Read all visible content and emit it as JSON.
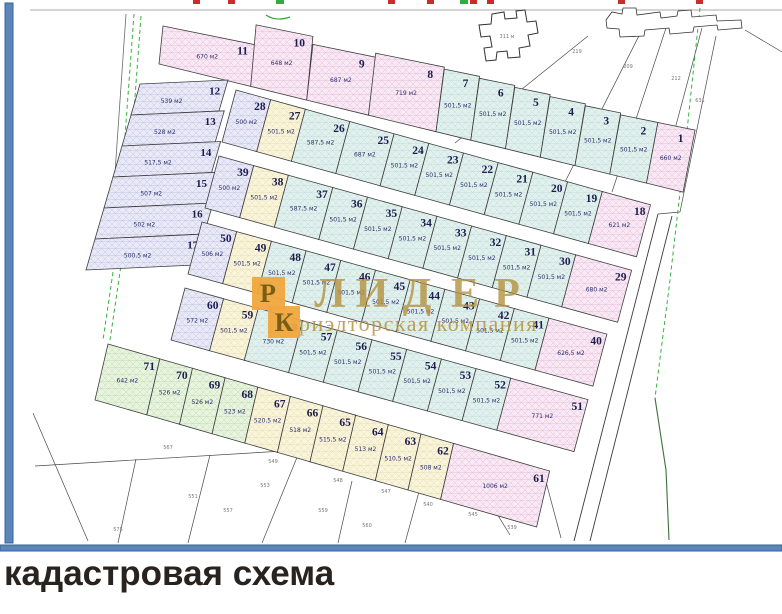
{
  "frame": {
    "caption": "кадастровая схема"
  },
  "watermark": {
    "letters": [
      "Л",
      "И",
      "Д",
      "Е",
      "Р"
    ],
    "subtitle": "риэлторская компания",
    "square1": "Р",
    "square2": "К"
  },
  "palette": {
    "pink": {
      "fill": "#f8e9f4",
      "hatch": "#e5bcdb"
    },
    "cyan": {
      "fill": "#e3f1ee",
      "hatch": "#bedcd6"
    },
    "lavender": {
      "fill": "#e9e9f7",
      "hatch": "#c0c3e3"
    },
    "cream": {
      "fill": "#f9f4da",
      "hatch": "#e7ddb4"
    },
    "green": {
      "fill": "#e8f4e0",
      "hatch": "#bedcae"
    }
  },
  "accents": {
    "frame_blue": "#5b86b7",
    "frame_blue_dark": "#35629c",
    "gold": "#b5923f",
    "orange": "#f0a63d",
    "red_mark": "#cc2b2b",
    "green_mark": "#2fae3f",
    "boundary_green": "#35b33f",
    "boundary_green_dark": "#3f6f3a"
  },
  "map": {
    "building_label": "311 м",
    "rows": [
      {
        "id": "strip-top",
        "plots": [
          {
            "n": "11",
            "a": "670 м2",
            "c": "pink"
          },
          {
            "n": "10",
            "a": "648 м2",
            "c": "pink"
          },
          {
            "n": "9",
            "a": "687 м2",
            "c": "pink"
          },
          {
            "n": "8",
            "a": "719 м2",
            "c": "pink"
          },
          {
            "n": "7",
            "a": "501,5 м2",
            "c": "cyan"
          },
          {
            "n": "6",
            "a": "501,5 м2",
            "c": "cyan"
          },
          {
            "n": "5",
            "a": "501,5 м2",
            "c": "cyan"
          },
          {
            "n": "4",
            "a": "501,5 м2",
            "c": "cyan"
          },
          {
            "n": "3",
            "a": "501,5 м2",
            "c": "cyan"
          },
          {
            "n": "2",
            "a": "501,5 м2",
            "c": "cyan"
          },
          {
            "n": "1",
            "a": "660 м2",
            "c": "pink"
          }
        ]
      },
      {
        "id": "left-col",
        "plots": [
          {
            "n": "12",
            "a": "539 м2",
            "c": "lavender"
          },
          {
            "n": "13",
            "a": "528 м2",
            "c": "lavender"
          },
          {
            "n": "14",
            "a": "517,5 м2",
            "c": "lavender"
          },
          {
            "n": "15",
            "a": "507 м2",
            "c": "lavender"
          },
          {
            "n": "16",
            "a": "502 м2",
            "c": "lavender"
          },
          {
            "n": "17",
            "a": "500,5 м2",
            "c": "lavender"
          }
        ]
      },
      {
        "id": "row-2",
        "plots": [
          {
            "n": "28",
            "a": "500 м2",
            "c": "lavender"
          },
          {
            "n": "27",
            "a": "501,5 м2",
            "c": "cream"
          },
          {
            "n": "26",
            "a": "587,5 м2",
            "c": "cyan"
          },
          {
            "n": "25",
            "a": "687 м2",
            "c": "cyan"
          },
          {
            "n": "24",
            "a": "501,5 м2",
            "c": "cyan"
          },
          {
            "n": "23",
            "a": "501,5 м2",
            "c": "cyan"
          },
          {
            "n": "22",
            "a": "501,5 м2",
            "c": "cyan"
          },
          {
            "n": "21",
            "a": "501,5 м2",
            "c": "cyan"
          },
          {
            "n": "20",
            "a": "501,5 м2",
            "c": "cyan"
          },
          {
            "n": "19",
            "a": "501,5 м2",
            "c": "cyan"
          },
          {
            "n": "18",
            "a": "621 м2",
            "c": "pink"
          }
        ]
      },
      {
        "id": "row-3",
        "plots": [
          {
            "n": "39",
            "a": "500 м2",
            "c": "lavender"
          },
          {
            "n": "38",
            "a": "501,5 м2",
            "c": "cream"
          },
          {
            "n": "37",
            "a": "587,5 м2",
            "c": "cyan"
          },
          {
            "n": "36",
            "a": "501,5 м2",
            "c": "cyan"
          },
          {
            "n": "35",
            "a": "501,5 м2",
            "c": "cyan"
          },
          {
            "n": "34",
            "a": "501,5 м2",
            "c": "cyan"
          },
          {
            "n": "33",
            "a": "501,5 м2",
            "c": "cyan"
          },
          {
            "n": "32",
            "a": "501,5 м2",
            "c": "cyan"
          },
          {
            "n": "31",
            "a": "501,5 м2",
            "c": "cyan"
          },
          {
            "n": "30",
            "a": "501,5 м2",
            "c": "cyan"
          },
          {
            "n": "29",
            "a": "680 м2",
            "c": "pink"
          }
        ]
      },
      {
        "id": "row-4",
        "plots": [
          {
            "n": "50",
            "a": "506 м2",
            "c": "lavender"
          },
          {
            "n": "49",
            "a": "501,5 м2",
            "c": "cream"
          },
          {
            "n": "48",
            "a": "501,5 м2",
            "c": "cyan"
          },
          {
            "n": "47",
            "a": "501,5 м2",
            "c": "cyan"
          },
          {
            "n": "46",
            "a": "501,5 м2",
            "c": "cyan"
          },
          {
            "n": "45",
            "a": "501,5 м2",
            "c": "cyan"
          },
          {
            "n": "44",
            "a": "501,5 м2",
            "c": "cyan"
          },
          {
            "n": "43",
            "a": "501,5 м2",
            "c": "cyan"
          },
          {
            "n": "42",
            "a": "501,5 м2",
            "c": "cyan"
          },
          {
            "n": "41",
            "a": "501,5 м2",
            "c": "cyan"
          },
          {
            "n": "40",
            "a": "626,5 м2",
            "c": "pink"
          }
        ]
      },
      {
        "id": "row-5",
        "plots": [
          {
            "n": "60",
            "a": "572 м2",
            "c": "lavender"
          },
          {
            "n": "59",
            "a": "501,5 м2",
            "c": "cream"
          },
          {
            "n": "58",
            "a": "730 м2",
            "c": "cyan"
          },
          {
            "n": "57",
            "a": "501,5 м2",
            "c": "cyan"
          },
          {
            "n": "56",
            "a": "501,5 м2",
            "c": "cyan"
          },
          {
            "n": "55",
            "a": "501,5 м2",
            "c": "cyan"
          },
          {
            "n": "54",
            "a": "501,5 м2",
            "c": "cyan"
          },
          {
            "n": "53",
            "a": "501,5 м2",
            "c": "cyan"
          },
          {
            "n": "52",
            "a": "501,5 м2",
            "c": "cyan"
          },
          {
            "n": "51",
            "a": "771 м2",
            "c": "pink"
          }
        ]
      },
      {
        "id": "row-6",
        "plots": [
          {
            "n": "71",
            "a": "642 м2",
            "c": "green"
          },
          {
            "n": "70",
            "a": "526 м2",
            "c": "green"
          },
          {
            "n": "69",
            "a": "526 м2",
            "c": "green"
          },
          {
            "n": "68",
            "a": "523 м2",
            "c": "green"
          },
          {
            "n": "67",
            "a": "520,5 м2",
            "c": "cream"
          },
          {
            "n": "66",
            "a": "518 м2",
            "c": "cream"
          },
          {
            "n": "65",
            "a": "515,5 м2",
            "c": "cream"
          },
          {
            "n": "64",
            "a": "513 м2",
            "c": "cream"
          },
          {
            "n": "63",
            "a": "510,5 м2",
            "c": "cream"
          },
          {
            "n": "62",
            "a": "508 м2",
            "c": "cream"
          },
          {
            "n": "61",
            "a": "1006 м2",
            "c": "pink"
          }
        ]
      }
    ],
    "bg_labels": [
      "219",
      "209",
      "212",
      "631",
      "567",
      "549",
      "551",
      "553",
      "557",
      "548",
      "547",
      "559",
      "560",
      "540",
      "545",
      "539",
      "575"
    ]
  }
}
